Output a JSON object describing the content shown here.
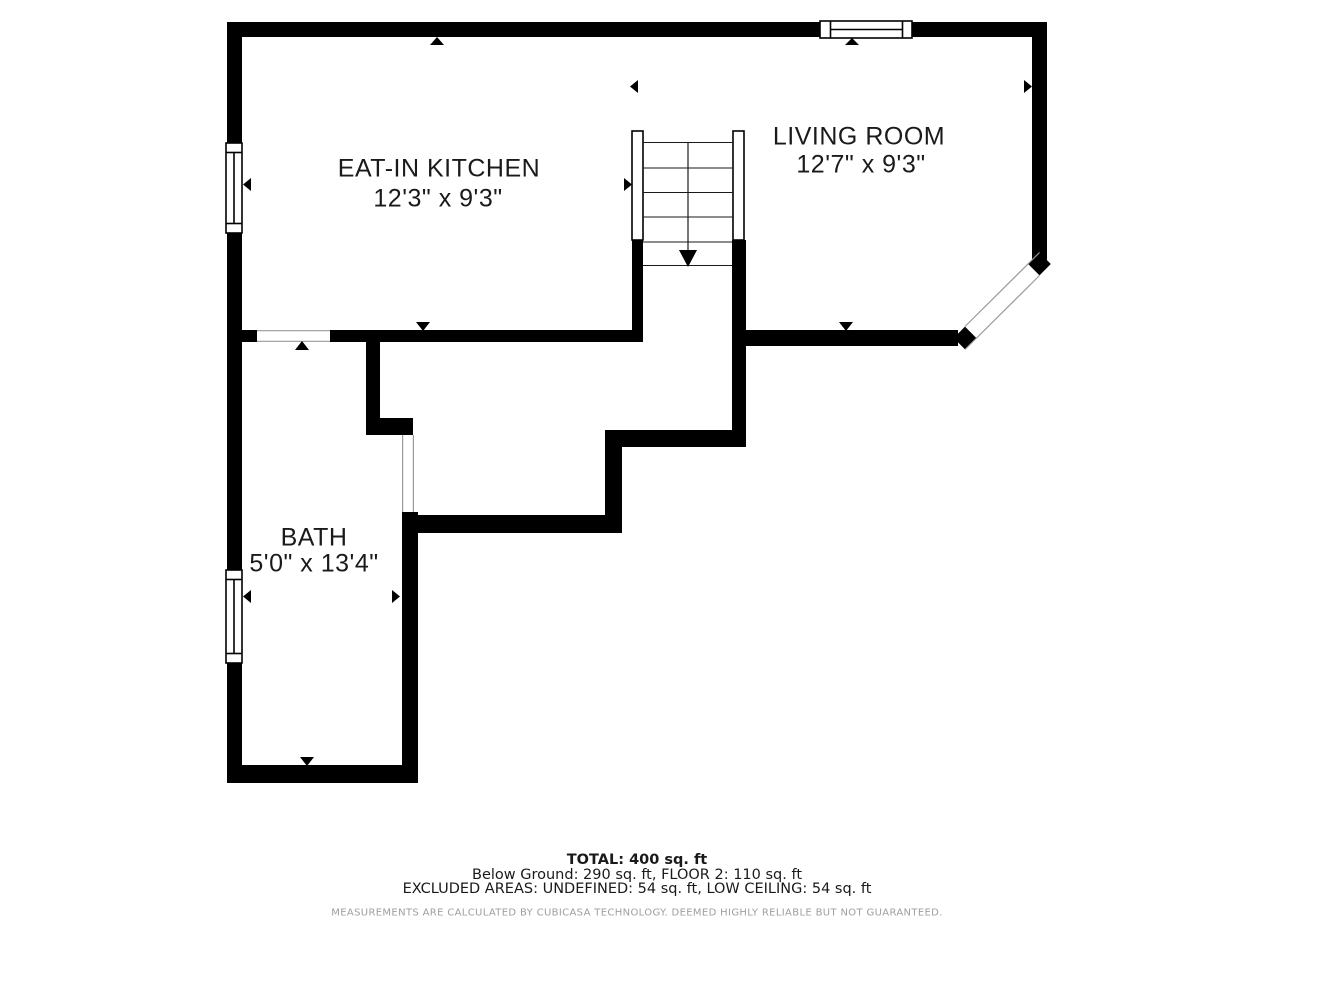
{
  "floorplan": {
    "rooms": [
      {
        "name": "EAT-IN KITCHEN",
        "dimensions": "12'3\" x 9'3\""
      },
      {
        "name": "LIVING ROOM",
        "dimensions": "12'7\" x 9'3\""
      },
      {
        "name": "BATH",
        "dimensions": "5'0\" x 13'4\""
      }
    ],
    "summary": {
      "total": "TOTAL: 400 sq. ft",
      "floors": "Below Ground: 290 sq. ft, FLOOR 2: 110 sq. ft",
      "excluded": "EXCLUDED AREAS: UNDEFINED: 54 sq. ft, LOW CEILING: 54 sq. ft"
    },
    "disclaimer": "MEASUREMENTS ARE CALCULATED BY CUBICASA TECHNOLOGY. DEEMED HIGHLY RELIABLE BUT NOT GUARANTEED.",
    "colors": {
      "wall": "#000000",
      "background": "#ffffff",
      "room_label": "#1a1a1a",
      "opening_line": "#9a9a9a",
      "disclaimer_text": "#9e9e9e"
    }
  }
}
